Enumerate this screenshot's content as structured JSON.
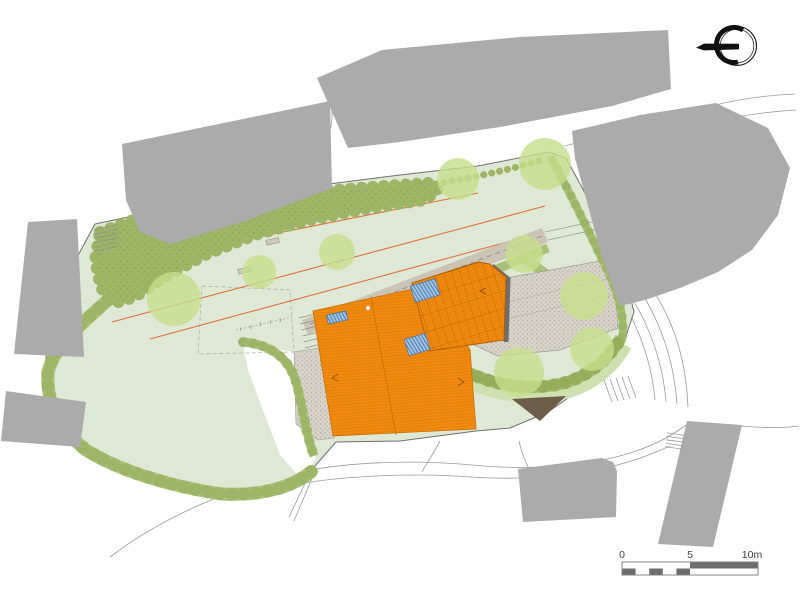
{
  "scale_bar": {
    "labels": [
      "0",
      "5",
      "10m"
    ],
    "unit": "m",
    "total_meters": 10,
    "segment_meters": 1
  },
  "north_arrow": {
    "icon": "north-arrow-icon",
    "direction": "left"
  },
  "features": [
    "site-lawn",
    "perimeter-hedge",
    "tree-mass",
    "tree-canopy",
    "main-building-roof",
    "annex-roof",
    "roof-skylight",
    "paved-terrace",
    "entrance-court",
    "garden-path",
    "garden-bench",
    "contour-line",
    "neighbor-building",
    "road",
    "stairs",
    "driveway-ramp",
    "north-arrow",
    "scale-bar"
  ],
  "colors": {
    "lawn": "#dee8d4",
    "treemass": "#9db566",
    "hedgedark": "#94ae5c",
    "canopy": "#c6de8c",
    "roof": "#f18a10",
    "roofline": "#c96f00",
    "bldg": "#ababab",
    "path": "#cbc3b4",
    "stipplebg": "#d9d4ca",
    "road": "#9b9b9b",
    "contour": "#e0703c",
    "boundary": "#6f6f6f",
    "sky": "#a6c6e2",
    "skystripe": "#4a7fb5",
    "dark": "#6e6e6e",
    "strip": "#a9c177",
    "brown": "#6d5c48",
    "ink": "#111111",
    "label": "#3f3f3f"
  }
}
